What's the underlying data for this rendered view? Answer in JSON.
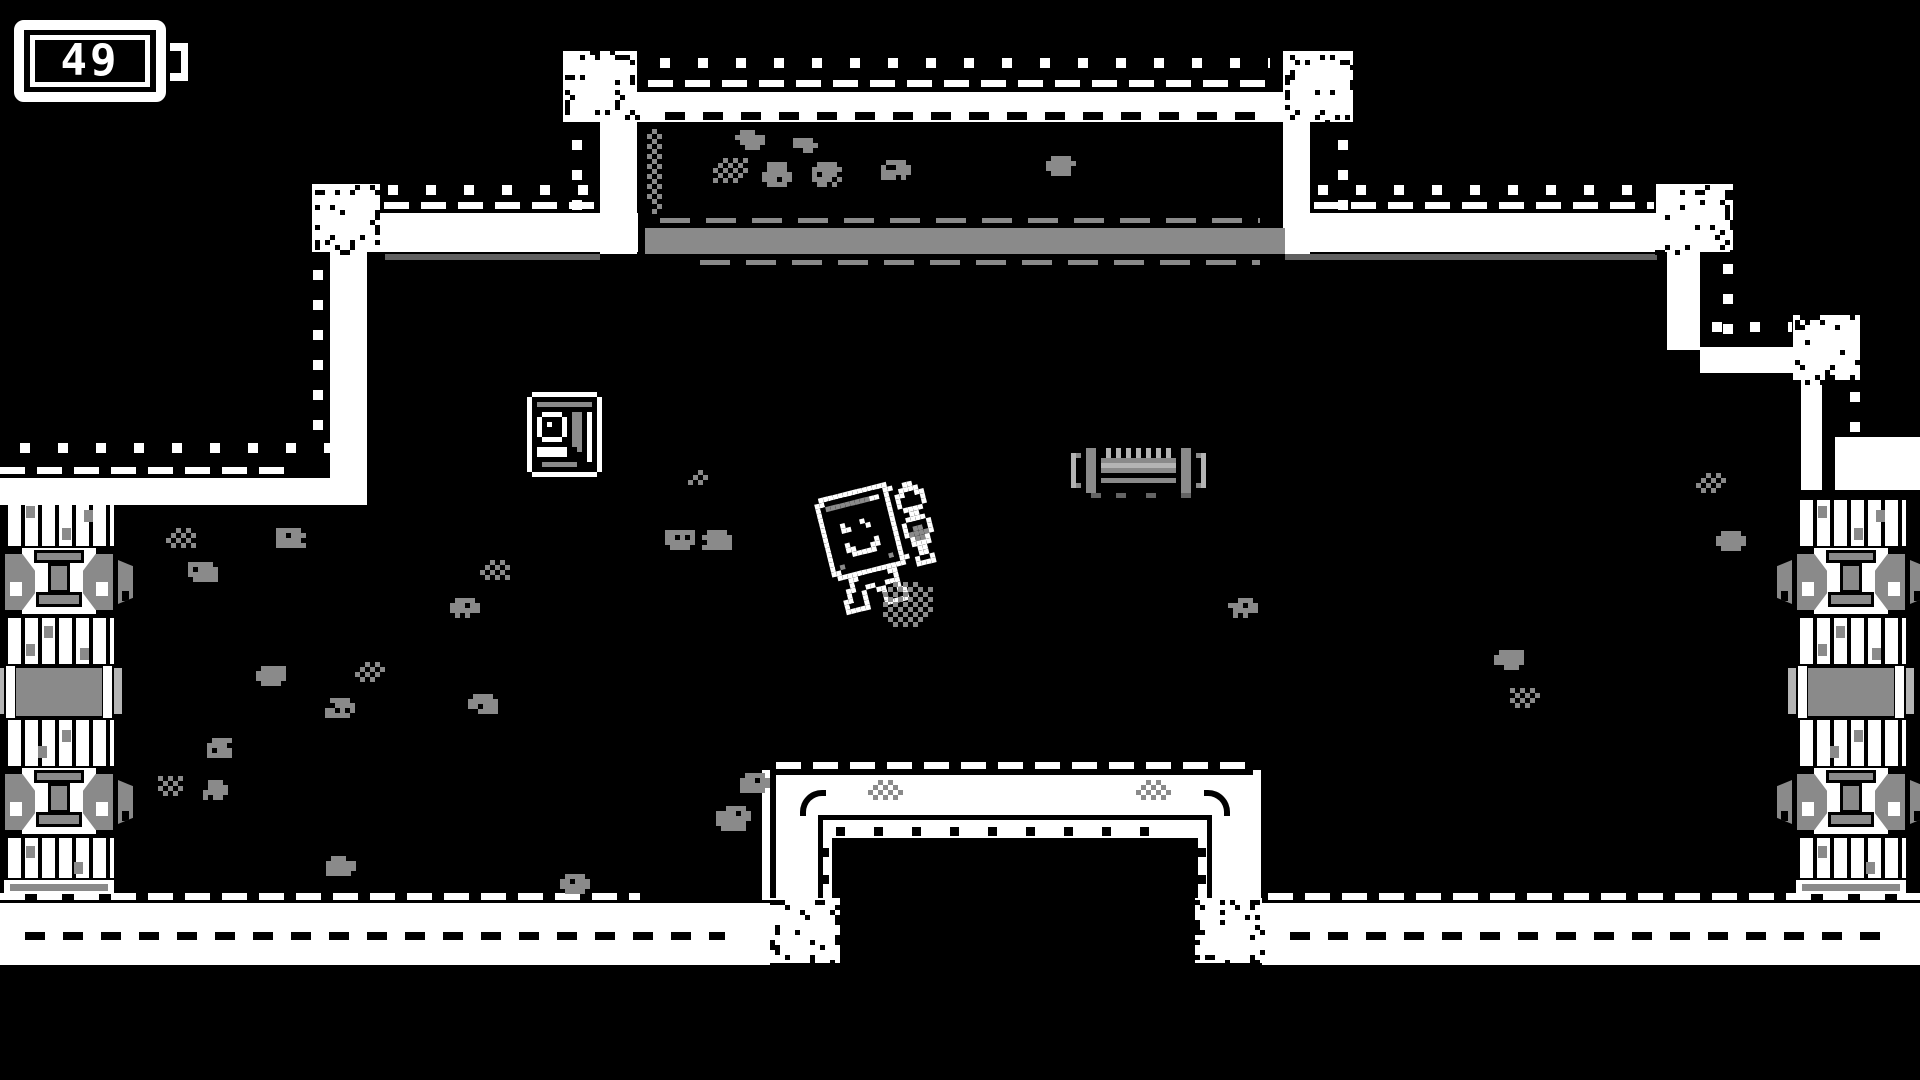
{
  "hud": {
    "battery_value": "49"
  },
  "palette": {
    "background": "#000000",
    "foreground": "#ffffff",
    "gray": "#8a8a8a",
    "light_gray": "#b4b4b4",
    "dark_gray": "#606060"
  },
  "scene": {
    "player_mech": {
      "x": 795,
      "y": 474,
      "rotation_deg": -14
    },
    "capsule_item": {
      "x": 527,
      "y": 392
    },
    "pipe_debris": {
      "x": 1071,
      "y": 448
    },
    "pillars": [
      {
        "x": 4,
        "y": 500
      },
      {
        "x": 1796,
        "y": 500
      }
    ],
    "speckle_blocks": [
      [
        563,
        51,
        74,
        71
      ],
      [
        1283,
        51,
        70,
        71
      ],
      [
        312,
        184,
        68,
        68
      ],
      [
        1656,
        184,
        77,
        68
      ],
      [
        1793,
        315,
        67,
        65
      ],
      [
        770,
        898,
        70,
        65
      ],
      [
        1195,
        898,
        67,
        65
      ]
    ],
    "moss_spots": [
      [
        735,
        130,
        30,
        20,
        "s"
      ],
      [
        793,
        138,
        24,
        16,
        "s"
      ],
      [
        713,
        158,
        36,
        26,
        "c"
      ],
      [
        762,
        162,
        30,
        24,
        "s"
      ],
      [
        812,
        162,
        30,
        24,
        "s"
      ],
      [
        881,
        160,
        28,
        22,
        "s"
      ],
      [
        1046,
        156,
        30,
        22,
        "s"
      ],
      [
        647,
        124,
        16,
        92,
        "c"
      ],
      [
        688,
        470,
        20,
        14,
        "c"
      ],
      [
        665,
        530,
        28,
        20,
        "s"
      ],
      [
        702,
        530,
        28,
        20,
        "s"
      ],
      [
        166,
        528,
        30,
        20,
        "c"
      ],
      [
        276,
        528,
        28,
        20,
        "s"
      ],
      [
        188,
        562,
        28,
        20,
        "s"
      ],
      [
        480,
        560,
        28,
        20,
        "c"
      ],
      [
        450,
        598,
        28,
        20,
        "s"
      ],
      [
        256,
        666,
        28,
        20,
        "s"
      ],
      [
        355,
        662,
        28,
        20,
        "c"
      ],
      [
        325,
        698,
        28,
        20,
        "s"
      ],
      [
        468,
        694,
        28,
        20,
        "s"
      ],
      [
        207,
        738,
        26,
        18,
        "s"
      ],
      [
        158,
        776,
        26,
        18,
        "c"
      ],
      [
        203,
        780,
        26,
        18,
        "s"
      ],
      [
        326,
        856,
        28,
        20,
        "s"
      ],
      [
        560,
        874,
        30,
        20,
        "s"
      ],
      [
        740,
        773,
        28,
        22,
        "s"
      ],
      [
        716,
        806,
        36,
        26,
        "s"
      ],
      [
        1228,
        598,
        28,
        20,
        "s"
      ],
      [
        1494,
        650,
        28,
        20,
        "s"
      ],
      [
        1510,
        688,
        28,
        20,
        "c"
      ],
      [
        1696,
        473,
        32,
        18,
        "c"
      ],
      [
        1716,
        531,
        28,
        20,
        "s"
      ],
      [
        868,
        780,
        36,
        18,
        "c"
      ],
      [
        1136,
        780,
        36,
        18,
        "c"
      ]
    ]
  },
  "sprites": {
    "palette_map": {
      "#": "#000000",
      "w": "#ffffff",
      "g": "#8a8a8a",
      "l": "#b4b4b4",
      "d": "#646464"
    },
    "mech": [
      ".wwwwwwwwwwwwww.........",
      "ww############ww..ww....",
      "w#gggggggggww#w..wwww...",
      "w#...........#w.ww##ww..",
      "w#...........#w.w####w..",
      "w#...........#w.w####w..",
      "w#..w...w....#w..wwww...",
      "w#..ww...w...#w...ww....",
      "w#...........#w..wwww...",
      "w#...........#w.w####w..",
      "w#..w.....w..#w.w#gg#w..",
      "w#..ww...ww..#w.wggggw..",
      "w#...wwwww...#w..wggw...",
      "w#...........#w..wwww...",
      "w#g.........g#w...ww....",
      "ww############ww..ww....",
      ".wwwwwwwwwwwwww..w##w...",
      "...ww######ww....wwww...",
      "...w########w...........",
      "..ww##ww##www...........",
      "..w##w..ww##w...........",
      ".ww##w...w##ww..........",
      ".w###w...w###w..........",
      ".wwwww...wwwww.........."
    ],
    "capsule": [
      ".wwwwwwwwwwwww.",
      "w#############w",
      "w#ggggggggggg#w",
      "w#...........#w",
      "w#.wwww..gg.w#w",
      "w#w####w.gg.w#w",
      "w#w#w##w.gg.w#w",
      "w#w####w.gg.w#w",
      "w#w####w.gg.w#w",
      "w#.wwww..gg.w#w",
      "w#.......gg.w#w",
      "w#wwwwww..g.w#w",
      "w#wwwwww....w#w",
      "w#..........w#w",
      "w#.ggggggg...#w",
      "w#############w",
      ".wwwwwwwwwwwww."
    ],
    "pipe": [
      "...gg..l.l.l.l.l.l.l..gg...",
      "lg.gg..l.l.l.l.l.l.l..gg.gl",
      "l..gg.ggggggggggggggg.gg..l",
      "l..gg.lllllllllllllll.gg..l",
      "l..gg.ggggggggggggggg.gg..l",
      "l..gg.................gg..l",
      "l..gg.ggggggggggggggg.gg..l",
      "lg.gg.................gg.gl",
      "...gg.................gg...",
      "....dd...dd....dd.....dd..."
    ]
  }
}
